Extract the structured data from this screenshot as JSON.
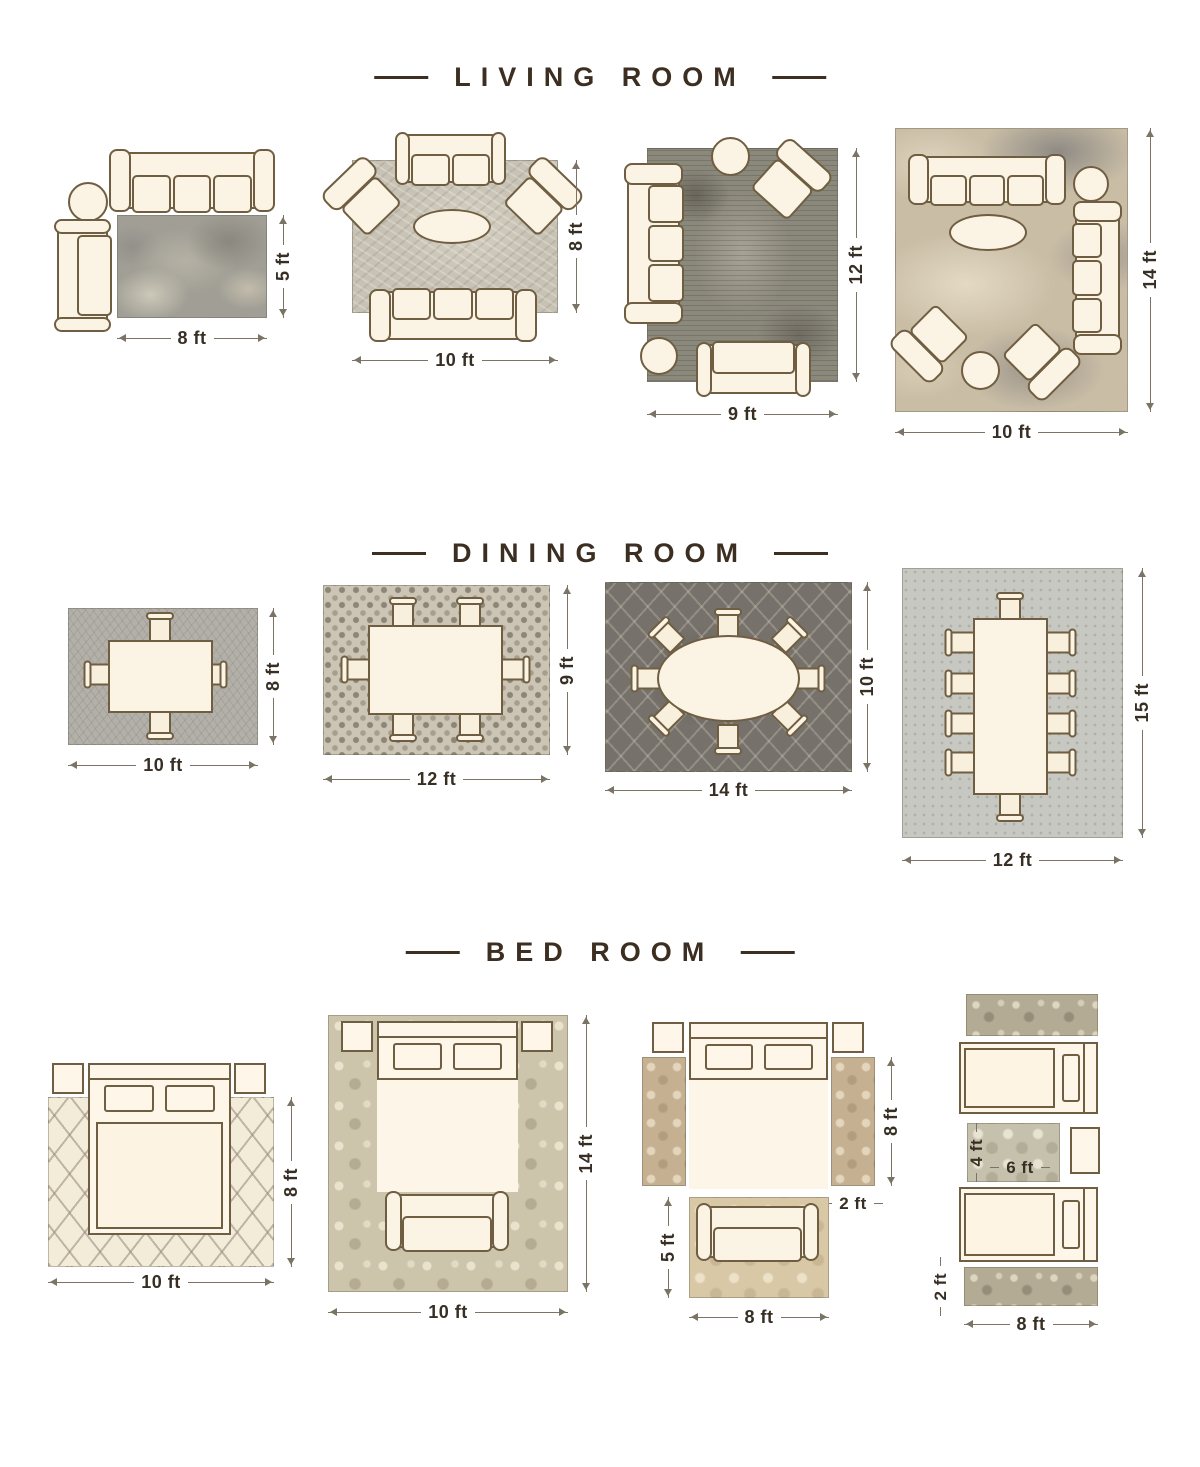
{
  "title": "Rug size guide",
  "palette": {
    "background": "#ffffff",
    "heading_text": "#3c2e21",
    "furniture_fill": "#fbf3e3",
    "furniture_outline": "#6f5e41",
    "dimension_text": "#372e24",
    "dimension_line": "#7b7366"
  },
  "sections": [
    {
      "title": "LIVING ROOM",
      "layouts": [
        {
          "name": "living-8x5",
          "w": "8 ft",
          "h": "5 ft",
          "furniture": [
            "sofa",
            "round side table",
            "bench",
            "area rug"
          ]
        },
        {
          "name": "living-10x8",
          "w": "10 ft",
          "h": "8 ft",
          "furniture": [
            "loveseat",
            "armchair",
            "armchair",
            "oval coffee table",
            "sofa",
            "area rug"
          ]
        },
        {
          "name": "living-9x12",
          "w": "9 ft",
          "h": "12 ft",
          "furniture": [
            "round side table",
            "armchair",
            "sofa",
            "round side table",
            "loveseat",
            "area rug"
          ]
        },
        {
          "name": "living-10x14",
          "w": "10 ft",
          "h": "14 ft",
          "furniture": [
            "sofa",
            "round side table",
            "sofa",
            "oval coffee table",
            "armchair",
            "armchair",
            "round side table",
            "area rug"
          ]
        }
      ]
    },
    {
      "title": "DINING ROOM",
      "layouts": [
        {
          "name": "dining-10x8",
          "w": "10 ft",
          "h": "8 ft",
          "furniture": [
            "dining table",
            "4 chairs",
            "area rug"
          ]
        },
        {
          "name": "dining-12x9",
          "w": "12 ft",
          "h": "9 ft",
          "furniture": [
            "dining table",
            "6 chairs",
            "area rug"
          ]
        },
        {
          "name": "dining-14x10",
          "w": "14 ft",
          "h": "10 ft",
          "furniture": [
            "oval dining table",
            "8 chairs",
            "area rug"
          ]
        },
        {
          "name": "dining-12x15",
          "w": "12 ft",
          "h": "15 ft",
          "furniture": [
            "long dining table",
            "10 chairs",
            "area rug"
          ]
        }
      ]
    },
    {
      "title": "BED ROOM",
      "layouts": [
        {
          "name": "bed-10x8",
          "w": "10 ft",
          "h": "8 ft",
          "furniture": [
            "bed",
            "nightstand",
            "nightstand",
            "area rug"
          ]
        },
        {
          "name": "bed-10x14",
          "w": "10 ft",
          "h": "14 ft",
          "furniture": [
            "bed",
            "nightstand",
            "nightstand",
            "bench",
            "area rug"
          ]
        },
        {
          "name": "bed-runners",
          "runner_len": "8 ft",
          "runner_w": "2 ft",
          "front_rug_h": "5 ft",
          "front_rug_w": "8 ft",
          "furniture": [
            "bed",
            "nightstand",
            "nightstand",
            "side runner",
            "side runner",
            "bench",
            "front rug"
          ]
        },
        {
          "name": "bed-twin",
          "mid_rug_h": "4 ft",
          "mid_rug_w": "6 ft",
          "runner_w": "2 ft",
          "runner_len": "8 ft",
          "furniture": [
            "twin bed",
            "twin bed",
            "nightstand",
            "runner",
            "runner",
            "center rug"
          ]
        }
      ]
    }
  ]
}
